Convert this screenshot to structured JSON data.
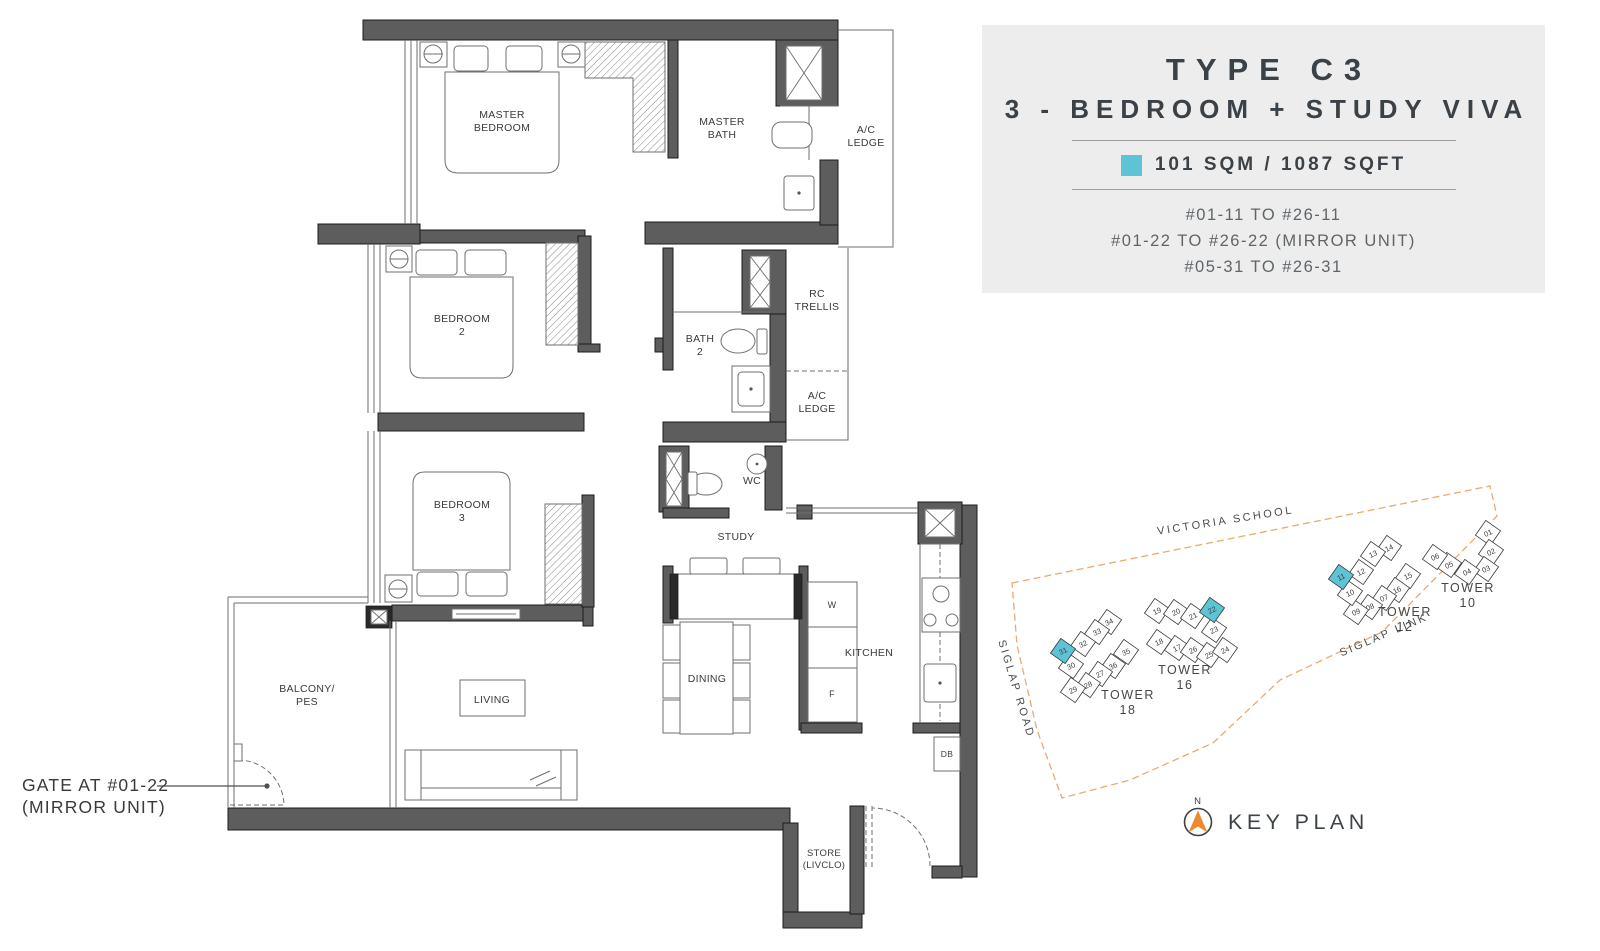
{
  "title_block": {
    "type_label": "TYPE C3",
    "name": "3 - BEDROOM + STUDY VIVA",
    "area": "101 SQM / 1087 SQFT",
    "swatch_color": "#5fc3d6",
    "unit_ranges": [
      "#01-11 TO #26-11",
      "#01-22 TO #26-22 (MIRROR UNIT)",
      "#05-31 TO #26-31"
    ]
  },
  "floorplan": {
    "labels": [
      {
        "id": "master-bedroom",
        "lines": [
          "MASTER",
          "BEDROOM"
        ],
        "x": 502,
        "y": 118
      },
      {
        "id": "master-bath",
        "lines": [
          "MASTER",
          "BATH"
        ],
        "x": 722,
        "y": 125
      },
      {
        "id": "ac-ledge-top",
        "lines": [
          "A/C",
          "LEDGE"
        ],
        "x": 866,
        "y": 133
      },
      {
        "id": "bedroom-2",
        "lines": [
          "BEDROOM",
          "2"
        ],
        "x": 462,
        "y": 322
      },
      {
        "id": "bath-2",
        "lines": [
          "BATH",
          "2"
        ],
        "x": 700,
        "y": 342
      },
      {
        "id": "rc-trellis",
        "lines": [
          "RC",
          "TRELLIS"
        ],
        "x": 817,
        "y": 297
      },
      {
        "id": "ac-ledge-mid",
        "lines": [
          "A/C",
          "LEDGE"
        ],
        "x": 817,
        "y": 399
      },
      {
        "id": "wc",
        "lines": [
          "WC"
        ],
        "x": 752,
        "y": 484
      },
      {
        "id": "bedroom-3",
        "lines": [
          "BEDROOM",
          "3"
        ],
        "x": 462,
        "y": 508
      },
      {
        "id": "study",
        "lines": [
          "STUDY"
        ],
        "x": 736,
        "y": 540
      },
      {
        "id": "dining",
        "lines": [
          "DINING"
        ],
        "x": 707,
        "y": 682
      },
      {
        "id": "kitchen",
        "lines": [
          "KITCHEN"
        ],
        "x": 869,
        "y": 656
      },
      {
        "id": "washer",
        "lines": [
          "W"
        ],
        "x": 832,
        "y": 608,
        "size": 9
      },
      {
        "id": "fridge",
        "lines": [
          "F"
        ],
        "x": 832,
        "y": 697,
        "size": 9
      },
      {
        "id": "living",
        "lines": [
          "LIVING"
        ],
        "x": 492,
        "y": 703
      },
      {
        "id": "balcony-pes",
        "lines": [
          "BALCONY/",
          "PES"
        ],
        "x": 307,
        "y": 692
      },
      {
        "id": "store",
        "lines": [
          "STORE",
          "(LIVCLO)"
        ],
        "x": 824,
        "y": 856,
        "size": 9.5
      },
      {
        "id": "db",
        "lines": [
          "DB"
        ],
        "x": 947,
        "y": 757,
        "size": 8.5
      }
    ],
    "gate_note": {
      "lines": [
        "GATE AT #01-22",
        "(MIRROR UNIT)"
      ],
      "x": 22,
      "y": 791
    }
  },
  "keyplan": {
    "label": "KEY PLAN",
    "north_label": "N",
    "boundary_color": "#e9aa70",
    "highlight_color": "#5fc3d6",
    "roads": [
      {
        "id": "victoria-school",
        "text": "VICTORIA SCHOOL",
        "x": 246,
        "y": 44,
        "rotate": -9
      },
      {
        "id": "siglap-road",
        "text": "SIGLAP ROAD",
        "x": 33,
        "y": 210,
        "rotate": 73
      },
      {
        "id": "siglap-link",
        "text": "SIGLAP LINK",
        "x": 405,
        "y": 158,
        "rotate": -23
      }
    ],
    "towers": [
      {
        "name": "TOWER",
        "number": "10",
        "label_x": 488,
        "label_y": 112,
        "units": [
          {
            "n": "01",
            "x": 508,
            "y": 53
          },
          {
            "n": "02",
            "x": 511,
            "y": 72
          },
          {
            "n": "03",
            "x": 506,
            "y": 89
          },
          {
            "n": "04",
            "x": 487,
            "y": 92
          },
          {
            "n": "05",
            "x": 469,
            "y": 85
          },
          {
            "n": "06",
            "x": 455,
            "y": 77
          }
        ]
      },
      {
        "name": "TOWER",
        "number": "12",
        "label_x": 425,
        "label_y": 136,
        "units": [
          {
            "n": "14",
            "x": 409,
            "y": 68
          },
          {
            "n": "13",
            "x": 393,
            "y": 74
          },
          {
            "n": "12",
            "x": 381,
            "y": 92
          },
          {
            "n": "15",
            "x": 428,
            "y": 96
          },
          {
            "n": "16",
            "x": 417,
            "y": 110
          },
          {
            "n": "07",
            "x": 404,
            "y": 118
          },
          {
            "n": "08",
            "x": 390,
            "y": 127
          },
          {
            "n": "09",
            "x": 376,
            "y": 132
          },
          {
            "n": "10",
            "x": 370,
            "y": 113
          },
          {
            "n": "11",
            "x": 361,
            "y": 97,
            "highlight": true
          }
        ]
      },
      {
        "name": "TOWER",
        "number": "16",
        "label_x": 205,
        "label_y": 194,
        "units": [
          {
            "n": "19",
            "x": 177,
            "y": 131
          },
          {
            "n": "20",
            "x": 196,
            "y": 132
          },
          {
            "n": "21",
            "x": 213,
            "y": 136
          },
          {
            "n": "23",
            "x": 234,
            "y": 150
          },
          {
            "n": "18",
            "x": 179,
            "y": 162
          },
          {
            "n": "17",
            "x": 197,
            "y": 168
          },
          {
            "n": "26",
            "x": 213,
            "y": 170
          },
          {
            "n": "25",
            "x": 229,
            "y": 175
          },
          {
            "n": "24",
            "x": 245,
            "y": 170
          },
          {
            "n": "22",
            "x": 232,
            "y": 130,
            "highlight": true
          }
        ]
      },
      {
        "name": "TOWER",
        "number": "18",
        "label_x": 148,
        "label_y": 219,
        "units": [
          {
            "n": "34",
            "x": 129,
            "y": 142
          },
          {
            "n": "33",
            "x": 117,
            "y": 152
          },
          {
            "n": "32",
            "x": 103,
            "y": 164
          },
          {
            "n": "30",
            "x": 91,
            "y": 186
          },
          {
            "n": "35",
            "x": 146,
            "y": 172
          },
          {
            "n": "36",
            "x": 133,
            "y": 186
          },
          {
            "n": "27",
            "x": 120,
            "y": 194
          },
          {
            "n": "28",
            "x": 108,
            "y": 205
          },
          {
            "n": "29",
            "x": 93,
            "y": 210
          },
          {
            "n": "31",
            "x": 83,
            "y": 171,
            "highlight": true
          }
        ]
      }
    ]
  }
}
